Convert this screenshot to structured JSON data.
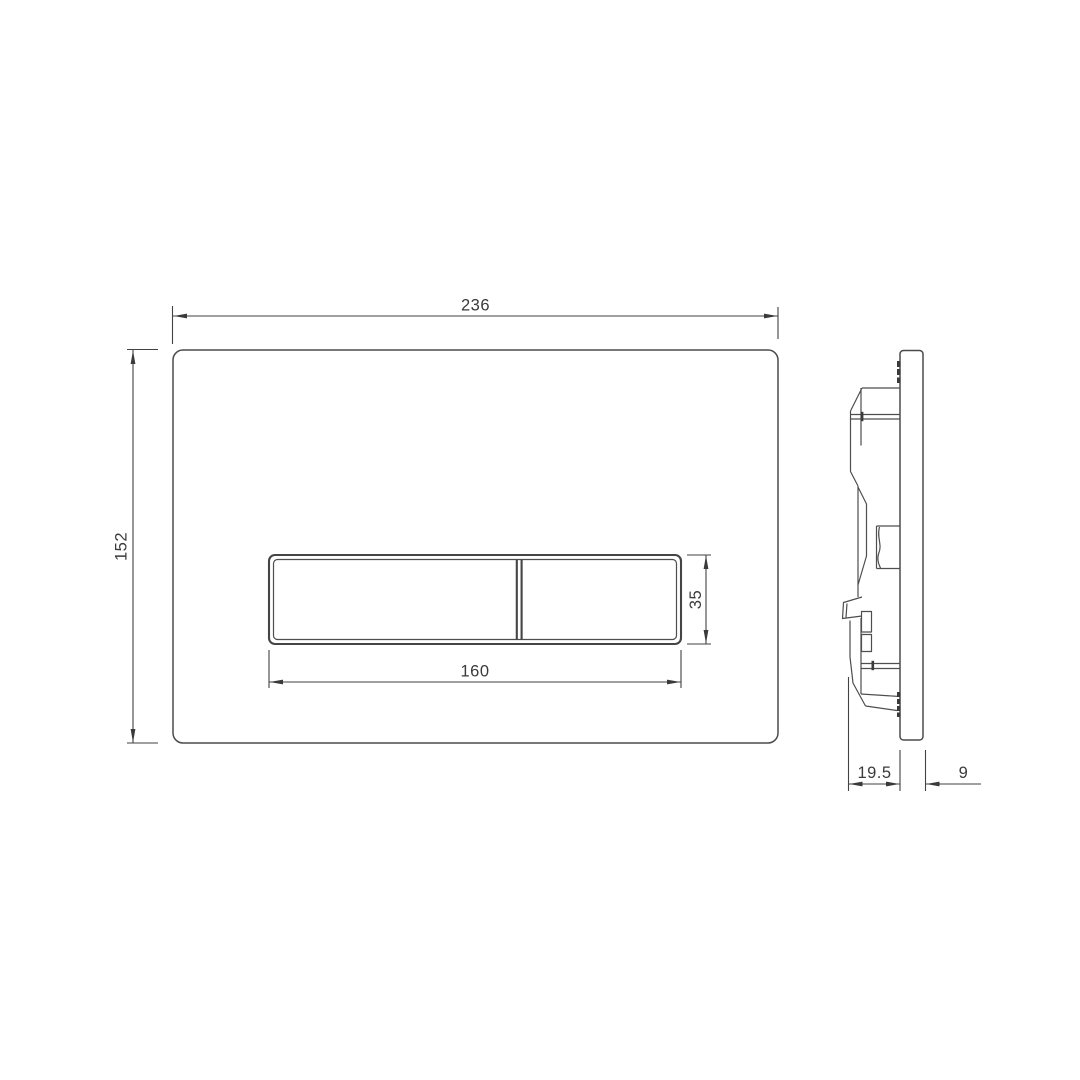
{
  "drawing": {
    "background_color": "#ffffff",
    "line_color": "#4b4b4b",
    "text_color": "#3a3a3a",
    "dimensions": {
      "plate_width": "236",
      "plate_height": "152",
      "button_cutout_width": "160",
      "button_cutout_height": "35",
      "installation_depth": "19.5",
      "plate_thickness": "9"
    }
  }
}
